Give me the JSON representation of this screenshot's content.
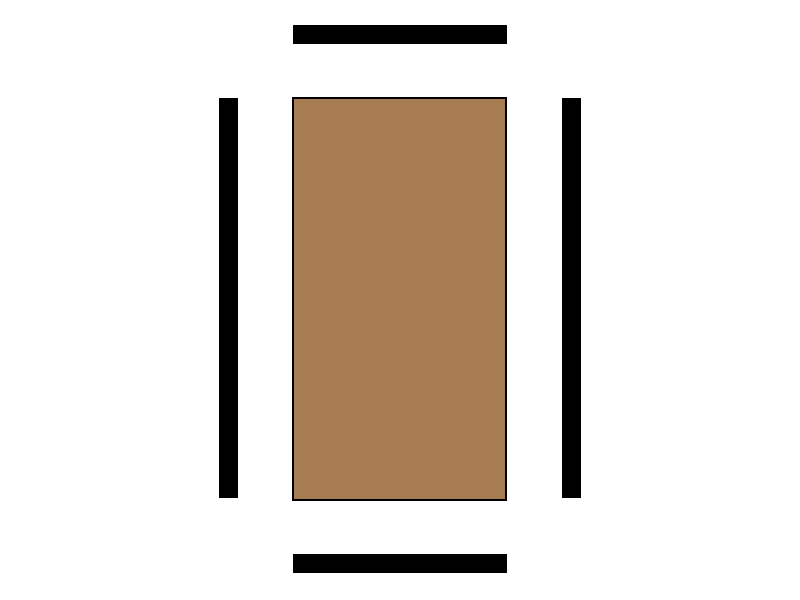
{
  "canvas": {
    "width": 800,
    "height": 600,
    "background_color": "#FFFFFF"
  },
  "colors": {
    "bar_fill": "#000000",
    "panel_fill": "#A87C52",
    "panel_border": "#000000"
  },
  "shapes": [
    {
      "id": "top-bar",
      "type": "rect",
      "x": 293,
      "y": 25,
      "width": 214,
      "height": 19,
      "fill": "#000000"
    },
    {
      "id": "bottom-bar",
      "type": "rect",
      "x": 293,
      "y": 554,
      "width": 214,
      "height": 19,
      "fill": "#000000"
    },
    {
      "id": "left-bar",
      "type": "rect",
      "x": 219,
      "y": 98,
      "width": 19,
      "height": 400,
      "fill": "#000000"
    },
    {
      "id": "right-bar",
      "type": "rect",
      "x": 562,
      "y": 98,
      "width": 19,
      "height": 400,
      "fill": "#000000"
    },
    {
      "id": "center-panel",
      "type": "rect",
      "x": 292,
      "y": 97,
      "width": 215,
      "height": 404,
      "fill": "#A87C52",
      "stroke": "#000000",
      "stroke_width": 2
    }
  ]
}
